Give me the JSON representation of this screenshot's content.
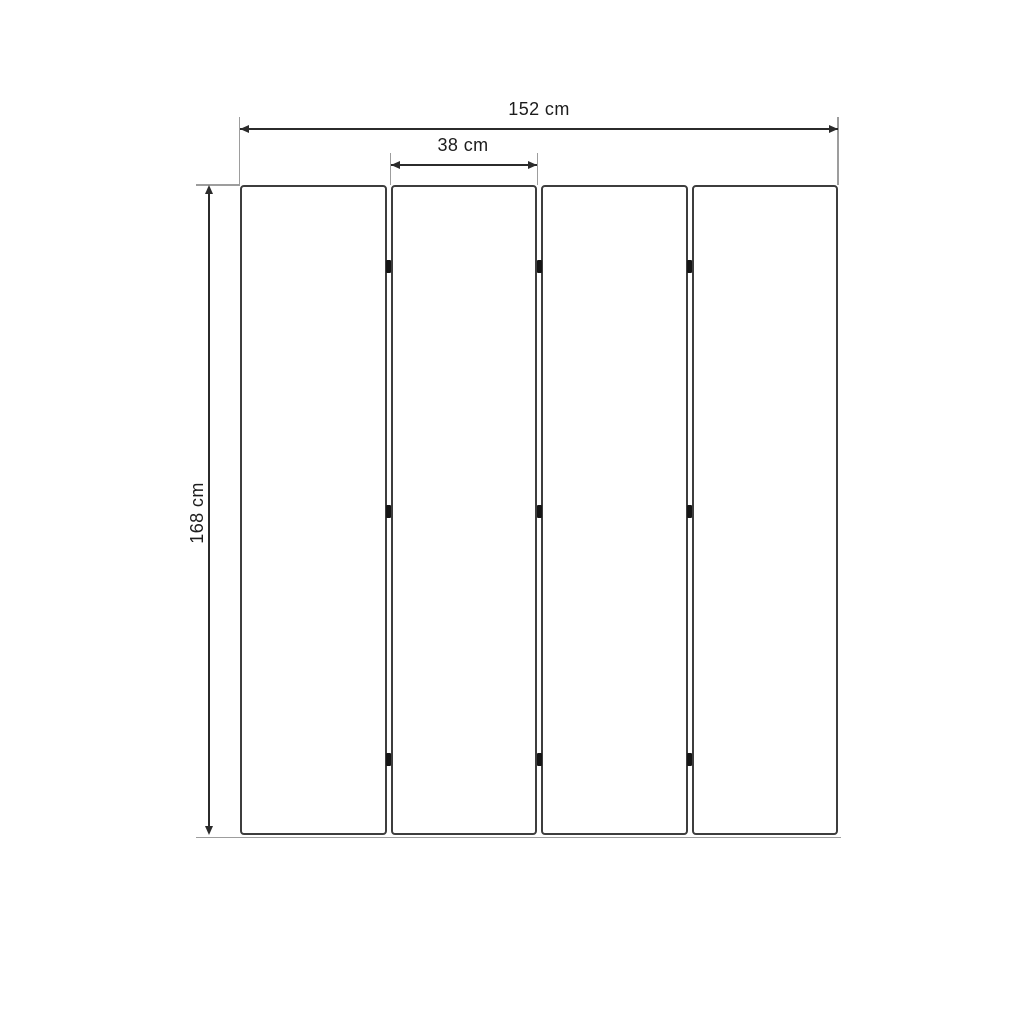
{
  "diagram": {
    "panel_count": 4,
    "hinge_rows_per_junction": 3,
    "dimensions": {
      "overall_width": "152 cm",
      "panel_width": "38 cm",
      "height": "168 cm"
    },
    "colors": {
      "background": "#ffffff",
      "panel_outline": "#3d3d3d",
      "dimension_line": "#2b2b2b",
      "extension_line": "#9d9d9d",
      "hinge": "#151515",
      "label_text": "#1c1c1c"
    }
  }
}
